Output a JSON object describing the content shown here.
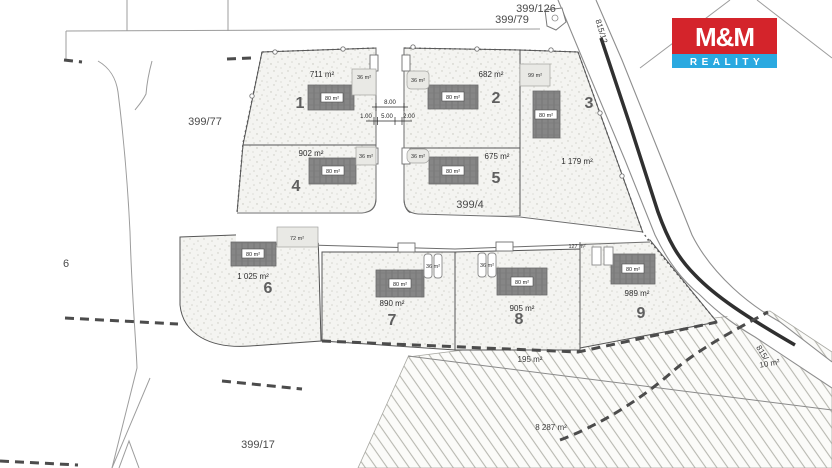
{
  "logo": {
    "name": "M&M",
    "reality": "REALITY"
  },
  "colors": {
    "logo_red": "#d4242b",
    "logo_blue": "#2aa9e0",
    "road_line": "#303030"
  },
  "parcels": {
    "p399_126": "399/126",
    "p399_79": "399/79",
    "p815_12": "815/12",
    "p399_77": "399/77",
    "p6": "6",
    "p399_4": "399/4",
    "p399_17": "399/17",
    "p815_partial": "815/",
    "area_8287": "8 287 m²",
    "area_195": "195 m²",
    "area_10": "10 m²"
  },
  "dimensions": {
    "total": "8.00",
    "left": "1.00",
    "middle": "5.00",
    "right": "2.00"
  },
  "plots": [
    {
      "number": "1",
      "area": "711 m²",
      "house_area": "80 m²",
      "aux_area": "36 m²"
    },
    {
      "number": "2",
      "area": "682 m²",
      "house_area": "80 m²",
      "aux_area": "36 m²"
    },
    {
      "number": "3",
      "area": "1 179 m²",
      "house_area": "80 m²",
      "aux_area": "99 m²"
    },
    {
      "number": "4",
      "area": "902 m²",
      "house_area": "80 m²",
      "aux_area": "36 m²"
    },
    {
      "number": "5",
      "area": "675 m²",
      "house_area": "80 m²",
      "aux_area": "36 m²"
    },
    {
      "number": "6",
      "area": "1 025 m²",
      "house_area": "80 m²",
      "aux_area": "72 m²"
    },
    {
      "number": "7",
      "area": "890 m²",
      "house_area": "80 m²",
      "aux_area": "36 m²"
    },
    {
      "number": "8",
      "area": "905 m²",
      "house_area": "80 m²",
      "aux_area": "36 m²"
    },
    {
      "number": "9",
      "area": "989 m²",
      "house_area": "80 m²",
      "aux_area": "127 m²"
    }
  ]
}
